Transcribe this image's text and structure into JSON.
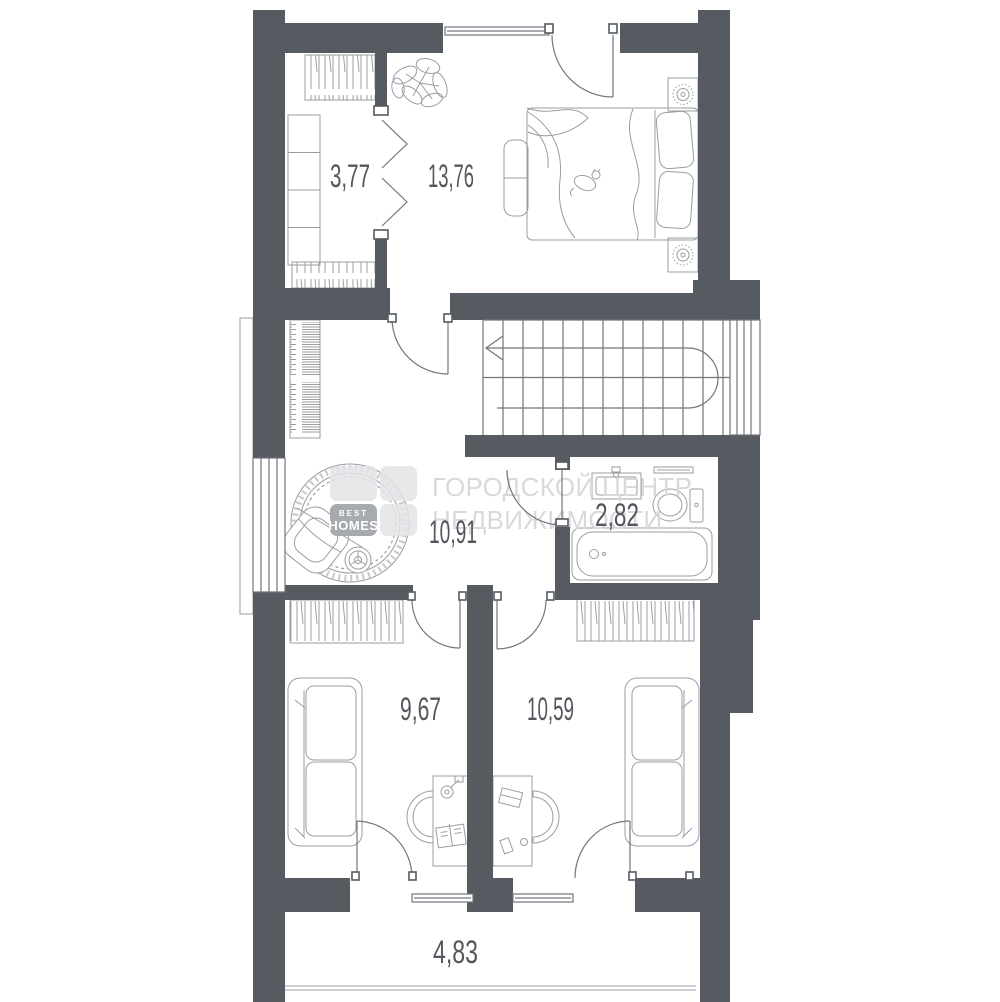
{
  "rooms": {
    "wardrobe": {
      "area": "3,77"
    },
    "bedroom": {
      "area": "13,76"
    },
    "hall": {
      "area": "10,91"
    },
    "bathroom": {
      "area": "2,82"
    },
    "room_left": {
      "area": "9,67"
    },
    "room_right": {
      "area": "10,59"
    },
    "balcony": {
      "area": "4,83"
    }
  },
  "watermark": {
    "line1": "ГОРОДСКОЙ ЦЕНТР",
    "line2": "НЕДВИЖИМОСТИ",
    "logo_top": "BEST",
    "logo_bottom": "HOMES"
  },
  "colors": {
    "wall": "#565a61",
    "furniture_line": "#9a9da2",
    "structure_line": "#72767c",
    "label_text": "#53575d",
    "watermark_text": "#d8d9db",
    "logo_badge": "#a7abb0",
    "logo_tile": "#e3e4e6"
  }
}
